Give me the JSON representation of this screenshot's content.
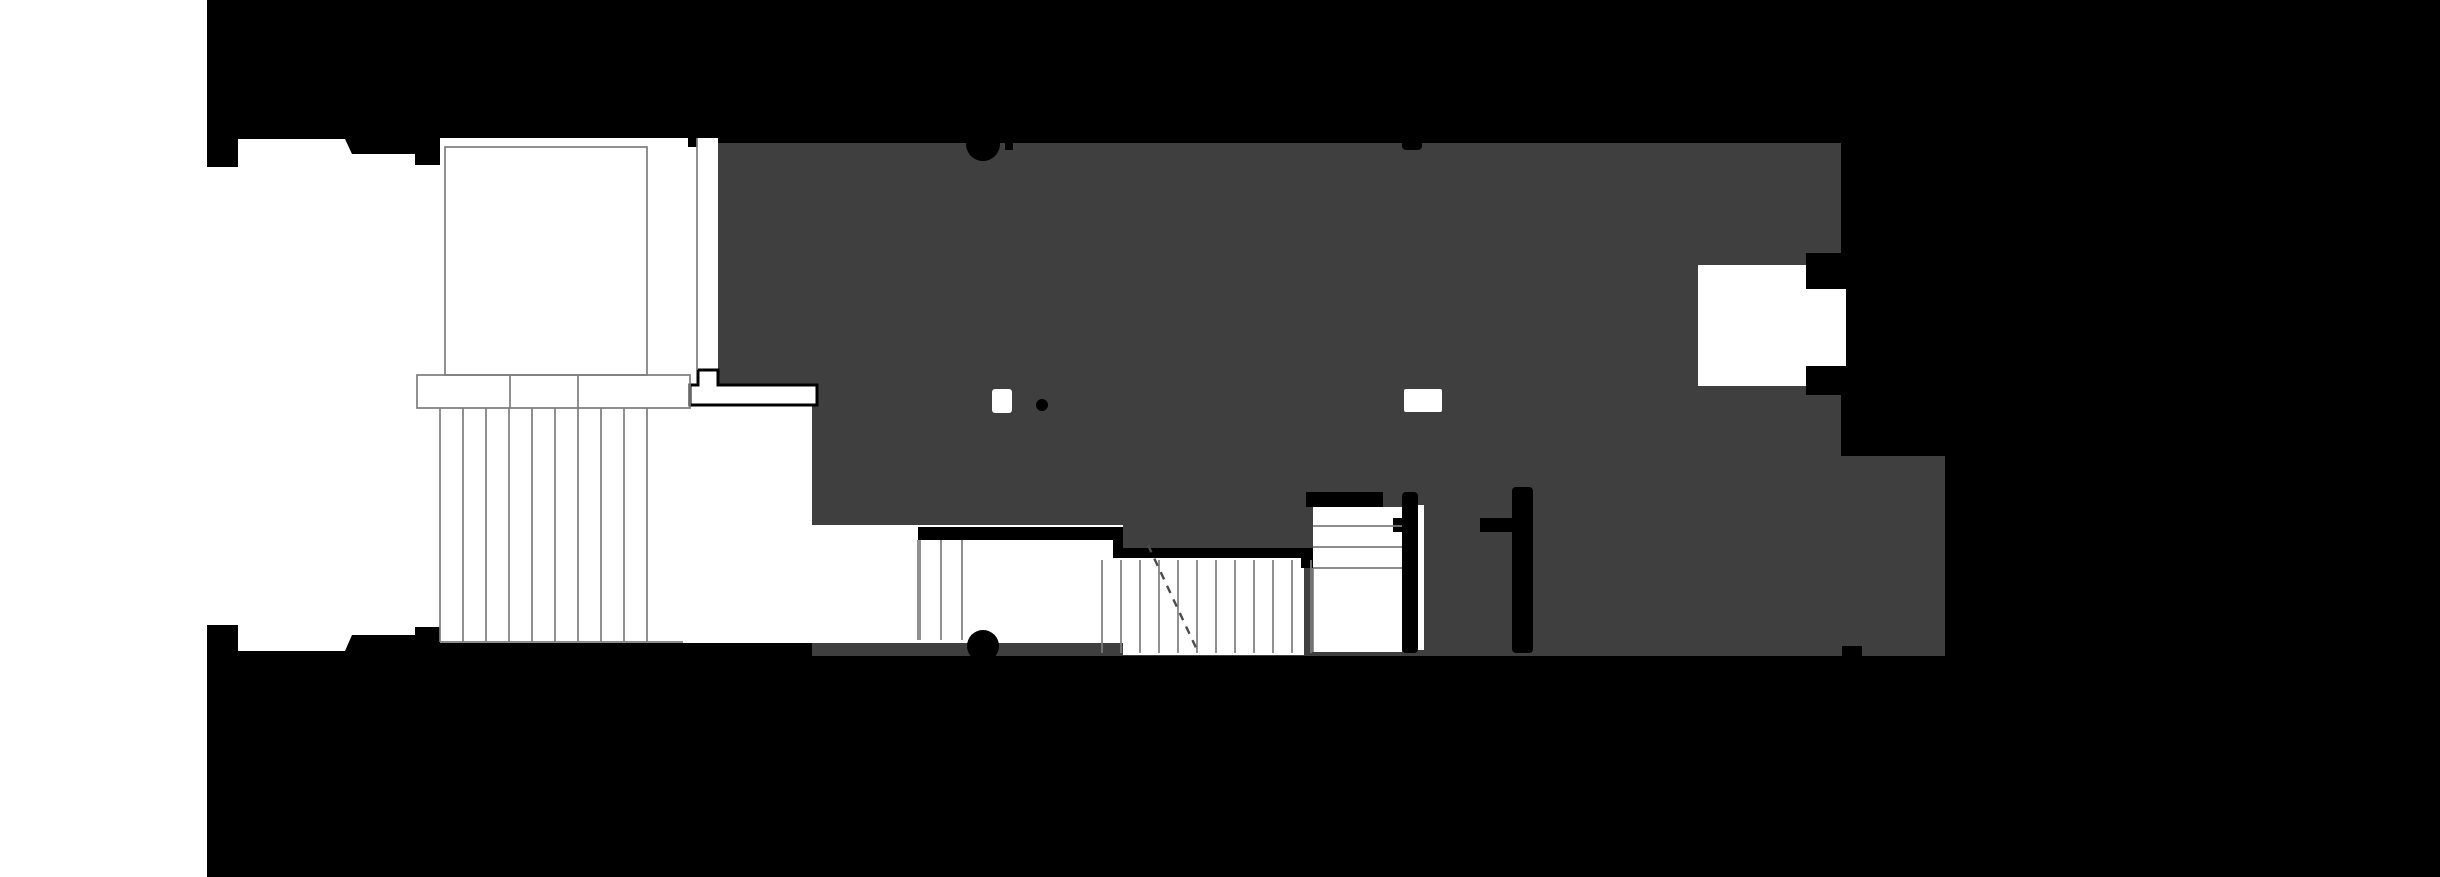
{
  "meta": {
    "kind": "architectural floor plan presentation drawing",
    "style": "black and white figure-ground plan, no text or dimensions visible"
  },
  "canvas": {
    "width": 2440,
    "height": 877
  },
  "colors": {
    "background": "#000000",
    "paper": "#ffffff",
    "floor_plate": "#3f3f3f",
    "wall_ink": "#000000",
    "thin_line": "#7d7d7d",
    "dash_line": "#4c4c4c"
  },
  "regions": {
    "left_margin": "white paper margin along left edge",
    "context_mass": "surrounding urban context rendered solid black",
    "entry_court": "white entry court with outlined room and wide exterior stair",
    "floor_plate": "dark grey main floor plate",
    "passage_slot": "outlined side passage slot through plate edge",
    "window_opening_left": "small white opening in plate (left)",
    "window_opening_right": "small white opening in plate (right)",
    "column_marks": "semicircular column marks on top and bottom plate edges",
    "lower_hall": "white split-level hall with two stair flights",
    "switchback_stair_room": "white stair room with horizontal treads",
    "rear_corridor": "grey corridor between two black interior walls",
    "balcony_notch": "white recessed balcony opening on right edge",
    "rear_extension": "grey extension volume at lower right"
  },
  "stairs": [
    {
      "name": "entry-stair-risers",
      "axis": "x",
      "start": 440,
      "step": 23,
      "count": 10,
      "span": [
        408,
        642
      ]
    },
    {
      "name": "stair-b-risers",
      "axis": "x",
      "xs": [
        920,
        941,
        962
      ],
      "span": [
        540,
        640
      ]
    },
    {
      "name": "stair-c-risers",
      "axis": "x",
      "start": 1102,
      "step": 19,
      "count": 12,
      "span": [
        560,
        653
      ]
    },
    {
      "name": "stair-d-treads",
      "axis": "y",
      "ys": [
        526,
        547,
        568
      ],
      "span": [
        1313,
        1402
      ]
    },
    {
      "name": "landing-dividers",
      "axis": "x",
      "xs": [
        510,
        578
      ],
      "span": [
        375,
        408
      ]
    }
  ]
}
